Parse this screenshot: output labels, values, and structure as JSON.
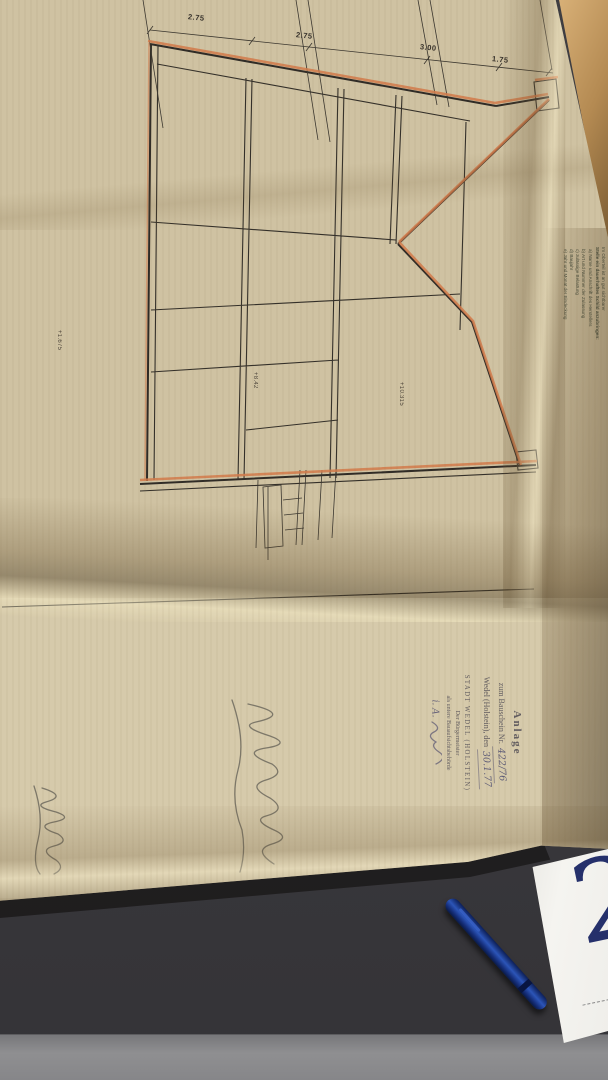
{
  "colors": {
    "paper": "#cfc2a2",
    "ink": "#33302b",
    "accent_orange": "#d27a4a",
    "stamp_green": "#2e7b52",
    "approval_ink": "#45404a",
    "pen_blue": "#1d3f9a",
    "card_numeral": "#25306b",
    "desk": "#3a393d"
  },
  "drawing": {
    "dimension_labels": [
      "2.75",
      "2.75",
      "3.00",
      "1.75"
    ],
    "elevation_labels": [
      "+1.675",
      "+8.42",
      "+10.315"
    ]
  },
  "stamp_conditions": {
    "line1": "Hierzu siehe Bedingungen",
    "line2": "und Auflagen im Bauschein"
  },
  "stamp_exemption": {
    "line1": "Im übrigen siehe hierzu",
    "line2": "erteilte Befreiung und",
    "line3": "Ausnahmegenehmigung"
  },
  "notes": {
    "heading1": "Im Oberteil ist an gut sichtbarer",
    "heading2": "Stelle ein dauerhaftes Schild anzubringen:",
    "items": [
      "a) Name und Anschrift des Herstellers",
      "b) Art und Nummer der Zulassung",
      "c) zulässige Belastung",
      "d) Baujahr",
      "e) Jahr und Monat der Eindeckung"
    ]
  },
  "approval": {
    "title": "Anlage",
    "ref_label": "zum Bauschein Nr.",
    "ref_value": "422/76",
    "place_label": "Wedel (Holstein), den",
    "date_value": "30.1.77",
    "authority1": "STADT WEDEL (HOLSTEIN)",
    "authority2": "Der Bürgermeister",
    "authority3": "als untere Bauaufsichtsbehörde",
    "sig_prefix": "i. A."
  },
  "title_block": {
    "owner_label": "DER BAUHERR",
    "owner1": "MARILUISE SAHLING UND",
    "owner2": "5 MITBAUHERREN",
    "owner3": "2 WEDEL · SCHLOSSKAMP 26",
    "project_label": "BAUVORHABEN",
    "project1": "BEBAUUNG DES GRUNDSTÜCKS",
    "project2": "SCHLOSSKAMP 26 IN WEDEL",
    "sheet_title": "SCHNITT",
    "date_label": "DATUM",
    "date_value": "3.9.76",
    "plan_label": "PLAN / NR.",
    "plan_value": "104",
    "scale_label": "MASSTAB",
    "scale_value": "1:50",
    "architect_label": "DER ARCHITEKT",
    "architect1": "ROLF REIMER UND PARTNER",
    "architect2": "ELMSHORN · KIRCHENSTR. 47"
  },
  "desk_card": {
    "numeral": "2"
  }
}
